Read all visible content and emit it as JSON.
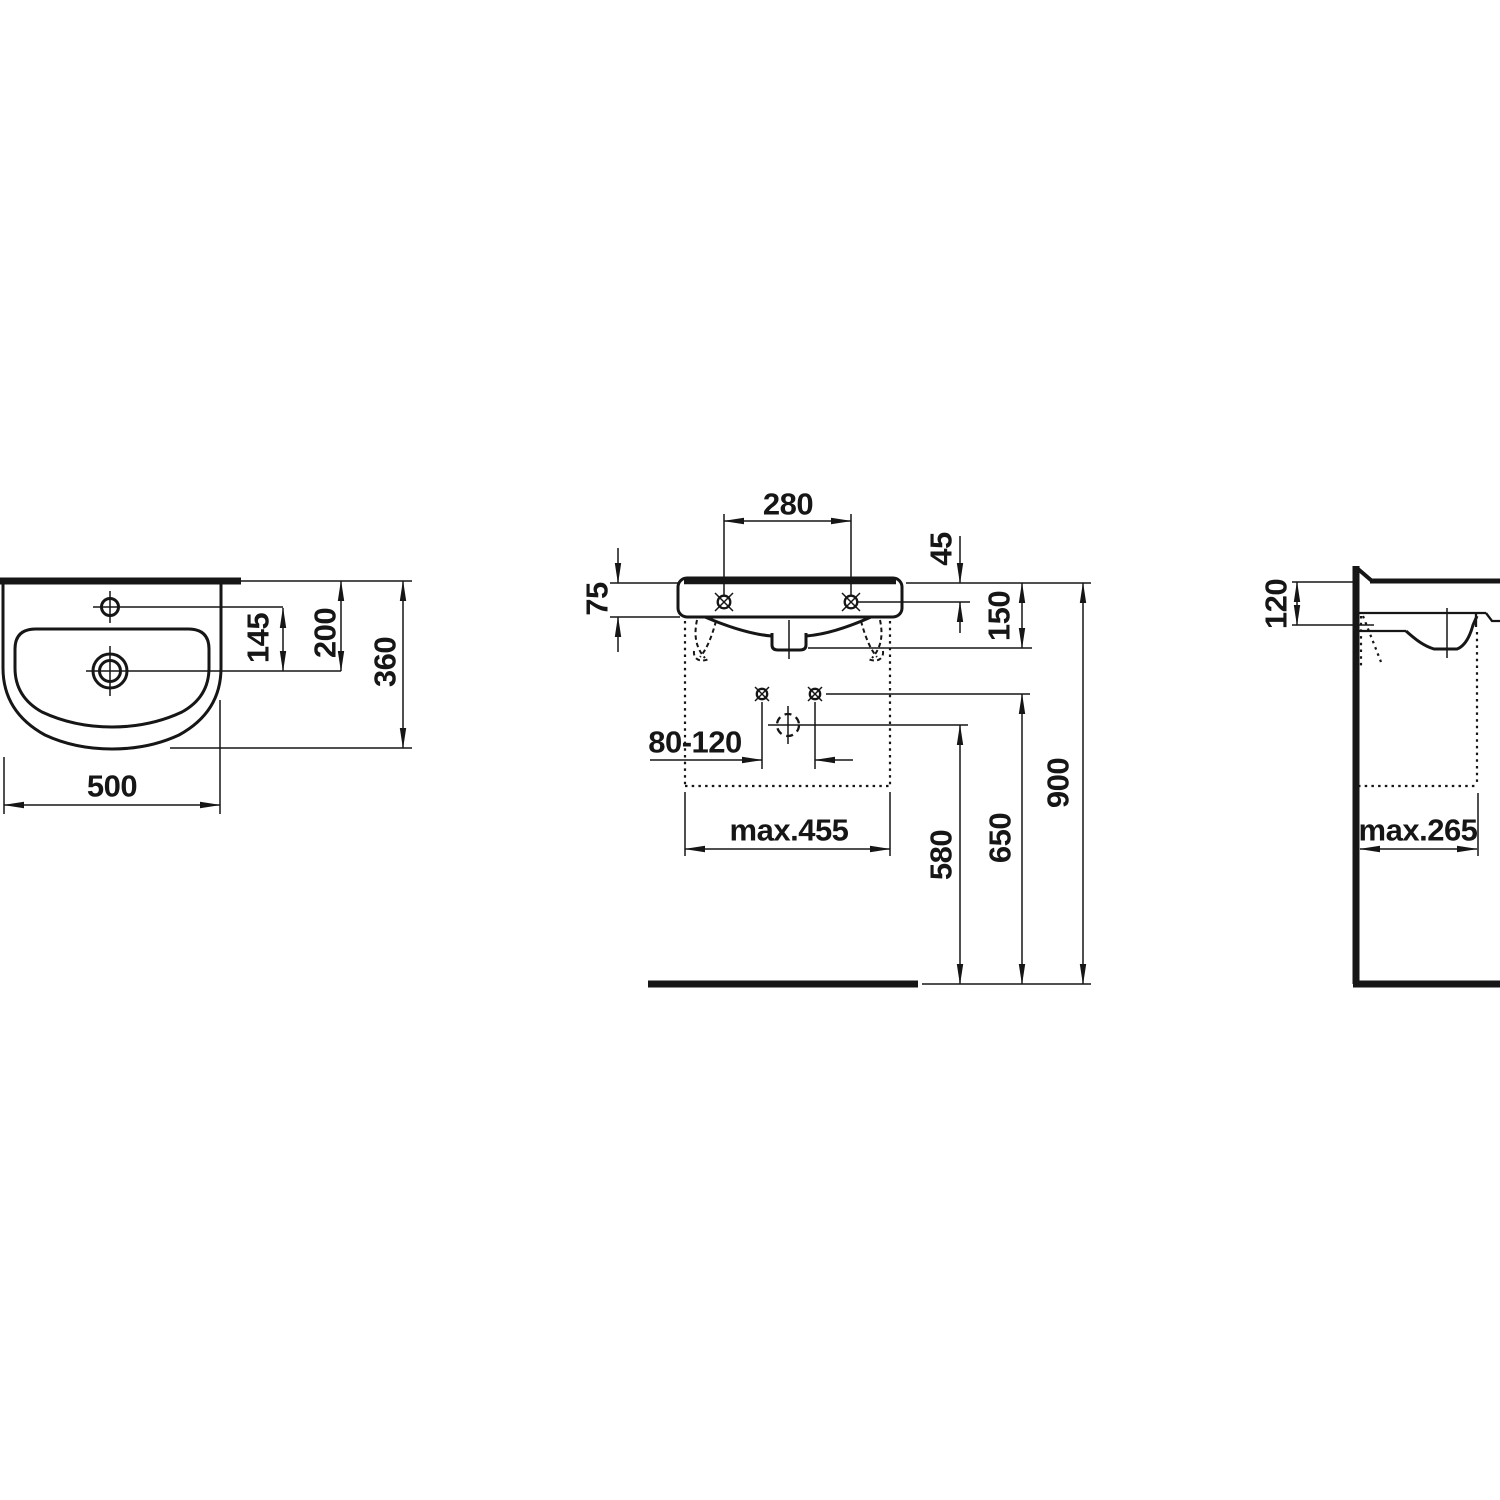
{
  "drawing": {
    "plan": {
      "d145": "145",
      "d200": "200",
      "d360": "360",
      "d500": "500"
    },
    "front": {
      "d280": "280",
      "d45": "45",
      "d75": "75",
      "d150": "150",
      "d80120": "80-120",
      "dmax455": "max.455",
      "d580": "580",
      "d650": "650",
      "d900": "900"
    },
    "side": {
      "d120": "120",
      "dmax265": "max.265"
    },
    "colors": {
      "line": "#161616",
      "background": "#ffffff"
    }
  }
}
